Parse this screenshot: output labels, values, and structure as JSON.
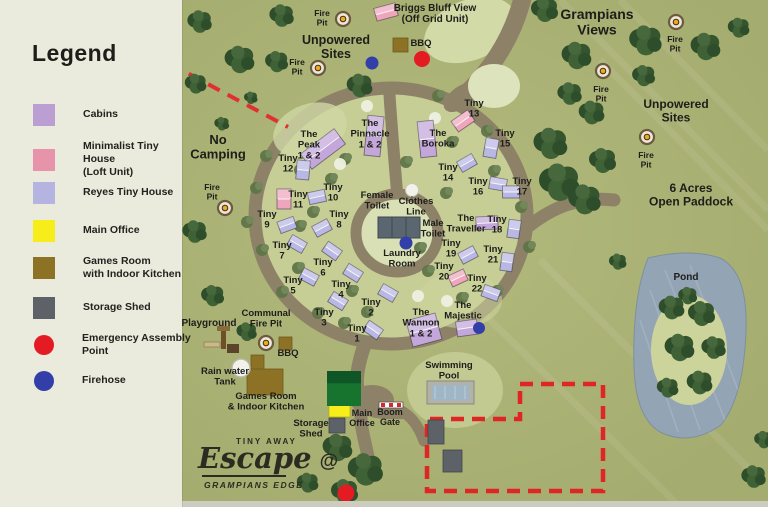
{
  "legend": {
    "title": "Legend",
    "items": [
      {
        "label": "Cabins",
        "color": "#bb9ed2",
        "shape": "square"
      },
      {
        "label": "Minimalist Tiny House\n(Loft Unit)",
        "color": "#e793aa",
        "shape": "square"
      },
      {
        "label": "Reyes Tiny House",
        "color": "#b5b4e0",
        "shape": "square"
      },
      {
        "label": "Main Office",
        "color": "#f7ed1b",
        "shape": "square"
      },
      {
        "label": "Games Room\nwith Indoor Kitchen",
        "color": "#8d7226",
        "shape": "square"
      },
      {
        "label": "Storage Shed",
        "color": "#5d6268",
        "shape": "square"
      },
      {
        "label": "Emergency Assembly\nPoint",
        "color": "#e51b23",
        "shape": "circle"
      },
      {
        "label": "Firehose",
        "color": "#333fa8",
        "shape": "circle"
      }
    ]
  },
  "logo": {
    "brand": "TINY AWAY",
    "script": "Escape",
    "at": "@",
    "sub": "GRAMPIANS EDGE"
  },
  "colors": {
    "cabin": "#c3a6da",
    "loft": "#efa6bd",
    "reyes": "#b9b8e4",
    "office": "#f7ed1b",
    "games": "#8d7226",
    "shed": "#5d6268",
    "emergency": "#e51b23",
    "firehose": "#333fa8",
    "road": "#8d8268",
    "grass": "#a5ac6f",
    "ring_grass": "#c6ce96",
    "light_grass": "#d8dfb4",
    "pond": "#93a4b4",
    "dash_red": "#e02525"
  },
  "map": {
    "labels": [
      {
        "id": "unpowered-sites-top",
        "lines": [
          "Unpowered",
          "Sites"
        ],
        "x": 336,
        "y": 44,
        "size": 12.5
      },
      {
        "id": "grampians-views",
        "lines": [
          "Grampians",
          "Views"
        ],
        "x": 597,
        "y": 19,
        "size": 14
      },
      {
        "id": "unpowered-sites-right",
        "lines": [
          "Unpowered",
          "Sites"
        ],
        "x": 676,
        "y": 108,
        "size": 12
      },
      {
        "id": "six-acres-open-paddock",
        "lines": [
          "6 Acres",
          "Open Paddock"
        ],
        "x": 691,
        "y": 192,
        "size": 12
      },
      {
        "id": "no-camping",
        "lines": [
          "No",
          "Camping"
        ],
        "x": 218,
        "y": 144,
        "size": 13
      },
      {
        "id": "pond",
        "lines": [
          "Pond"
        ],
        "x": 686,
        "y": 280,
        "size": 10
      },
      {
        "id": "female-toilet",
        "lines": [
          "Female",
          "Toilet"
        ],
        "x": 377,
        "y": 198,
        "size": 9.5
      },
      {
        "id": "clothes-line",
        "lines": [
          "Clothes",
          "Line"
        ],
        "x": 416,
        "y": 204,
        "size": 9.5
      },
      {
        "id": "male-toilet",
        "lines": [
          "Male",
          "Toilet"
        ],
        "x": 433,
        "y": 226,
        "size": 9.5
      },
      {
        "id": "laundry-room",
        "lines": [
          "Laundry",
          "Room"
        ],
        "x": 402,
        "y": 256,
        "size": 9.5
      },
      {
        "id": "swimming-pool",
        "lines": [
          "Swimming",
          "Pool"
        ],
        "x": 449,
        "y": 368,
        "size": 9.5
      },
      {
        "id": "main-office",
        "lines": [
          "Main",
          "Office"
        ],
        "x": 362,
        "y": 416,
        "size": 9
      },
      {
        "id": "boom-gate",
        "lines": [
          "Boom",
          "Gate"
        ],
        "x": 390,
        "y": 415,
        "size": 9
      },
      {
        "id": "storage-shed",
        "lines": [
          "Storage",
          "Shed"
        ],
        "x": 311,
        "y": 426,
        "size": 9.5
      },
      {
        "id": "games-room",
        "lines": [
          "Games Room",
          "& Indoor Kitchen"
        ],
        "x": 266,
        "y": 399,
        "size": 9.5
      },
      {
        "id": "rain-water-tank",
        "lines": [
          "Rain water",
          "Tank"
        ],
        "x": 225,
        "y": 374,
        "size": 9.5
      },
      {
        "id": "playground",
        "lines": [
          "Playground"
        ],
        "x": 209,
        "y": 326,
        "size": 10
      },
      {
        "id": "communal-fire-pit",
        "lines": [
          "Communal",
          "Fire Pit"
        ],
        "x": 266,
        "y": 316,
        "size": 9.5
      },
      {
        "id": "bbq-top",
        "lines": [
          "BBQ"
        ],
        "x": 421,
        "y": 46,
        "size": 9.5
      },
      {
        "id": "bbq-bottom",
        "lines": [
          "BBQ"
        ],
        "x": 288,
        "y": 356,
        "size": 9.5
      }
    ],
    "units": [
      {
        "id": "briggs-bluff-view",
        "lines": [
          "Briggs Bluff View",
          "(Off Grid Unit)"
        ],
        "lx": 435,
        "ly": 11,
        "size": 10,
        "bx": 386,
        "by": 12,
        "bw": 22,
        "bh": 13,
        "rot": -15,
        "type": "loft"
      },
      {
        "id": "the-peak",
        "lines": [
          "The",
          "Peak",
          "1 & 2"
        ],
        "lx": 309,
        "ly": 137,
        "bx": 323,
        "by": 149,
        "bw": 42,
        "bh": 19,
        "rot": -37,
        "type": "cabin"
      },
      {
        "id": "the-pinnacle",
        "lines": [
          "The",
          "Pinnacle",
          "1 & 2"
        ],
        "lx": 370,
        "ly": 126,
        "bx": 374,
        "by": 136,
        "bw": 16,
        "bh": 40,
        "rot": 6,
        "type": "cabin"
      },
      {
        "id": "the-boroka",
        "lines": [
          "The",
          "Boroka"
        ],
        "lx": 438,
        "ly": 136,
        "bx": 427,
        "by": 139,
        "bw": 16,
        "bh": 36,
        "rot": -6,
        "type": "cabin"
      },
      {
        "id": "the-traveller",
        "lines": [
          "The",
          "Traveller"
        ],
        "lx": 466,
        "ly": 221,
        "bx": 487,
        "by": 223,
        "bw": 22,
        "bh": 13,
        "rot": -3,
        "type": "cabin"
      },
      {
        "id": "the-wannon",
        "lines": [
          "The",
          "Wannon",
          "1 & 2"
        ],
        "lx": 421,
        "ly": 315,
        "bx": 424,
        "by": 330,
        "bw": 30,
        "bh": 27,
        "rot": -15,
        "type": "cabin"
      },
      {
        "id": "the-majestic",
        "lines": [
          "The",
          "Majestic"
        ],
        "lx": 463,
        "ly": 308,
        "bx": 467,
        "by": 328,
        "bw": 21,
        "bh": 15,
        "rot": -8,
        "type": "cabin"
      },
      {
        "id": "tiny-1",
        "lines": [
          "Tiny",
          "1"
        ],
        "lx": 357,
        "ly": 331,
        "bx": 373,
        "by": 330,
        "rot": 35,
        "type": "reyes"
      },
      {
        "id": "tiny-2",
        "lines": [
          "Tiny",
          "2"
        ],
        "lx": 371,
        "ly": 305,
        "bx": 388,
        "by": 293,
        "rot": 30,
        "type": "reyes"
      },
      {
        "id": "tiny-3",
        "lines": [
          "Tiny",
          "3"
        ],
        "lx": 324,
        "ly": 315,
        "bx": 338,
        "by": 301,
        "rot": 32,
        "type": "reyes"
      },
      {
        "id": "tiny-4",
        "lines": [
          "Tiny",
          "4"
        ],
        "lx": 341,
        "ly": 287,
        "bx": 353,
        "by": 273,
        "rot": 32,
        "type": "reyes"
      },
      {
        "id": "tiny-5",
        "lines": [
          "Tiny",
          "5"
        ],
        "lx": 293,
        "ly": 283,
        "bx": 309,
        "by": 277,
        "rot": 28,
        "type": "reyes"
      },
      {
        "id": "tiny-6",
        "lines": [
          "Tiny",
          "6"
        ],
        "lx": 323,
        "ly": 265,
        "bx": 332,
        "by": 251,
        "rot": 35,
        "type": "reyes"
      },
      {
        "id": "tiny-7",
        "lines": [
          "Tiny",
          "7"
        ],
        "lx": 282,
        "ly": 248,
        "bx": 297,
        "by": 244,
        "rot": 30,
        "type": "reyes"
      },
      {
        "id": "tiny-8",
        "lines": [
          "Tiny",
          "8"
        ],
        "lx": 339,
        "ly": 217,
        "bx": 322,
        "by": 228,
        "rot": -28,
        "type": "reyes"
      },
      {
        "id": "tiny-9",
        "lines": [
          "Tiny",
          "9"
        ],
        "lx": 267,
        "ly": 217,
        "bx": 287,
        "by": 225,
        "rot": -20,
        "type": "reyes"
      },
      {
        "id": "tiny-10",
        "lines": [
          "Tiny",
          "10"
        ],
        "lx": 333,
        "ly": 190,
        "bx": 317,
        "by": 197,
        "rot": -12,
        "type": "reyes"
      },
      {
        "id": "tiny-11",
        "lines": [
          "Tiny",
          "11"
        ],
        "lx": 298,
        "ly": 197,
        "bx": 284,
        "by": 199,
        "rot": 0,
        "type": "loft",
        "bw": 14,
        "bh": 20
      },
      {
        "id": "tiny-12",
        "lines": [
          "Tiny",
          "12"
        ],
        "lx": 288,
        "ly": 161,
        "bx": 303,
        "by": 170,
        "rot": 5,
        "type": "reyes",
        "bw": 13,
        "bh": 19
      },
      {
        "id": "tiny-13",
        "lines": [
          "Tiny",
          "13"
        ],
        "lx": 474,
        "ly": 106,
        "bx": 463,
        "by": 121,
        "rot": -35,
        "type": "loft",
        "bw": 20,
        "bh": 13
      },
      {
        "id": "tiny-14",
        "lines": [
          "Tiny",
          "14"
        ],
        "lx": 448,
        "ly": 170,
        "bx": 467,
        "by": 163,
        "rot": -30,
        "type": "reyes"
      },
      {
        "id": "tiny-15",
        "lines": [
          "Tiny",
          "15"
        ],
        "lx": 505,
        "ly": 136,
        "bx": 491,
        "by": 148,
        "rot": 10,
        "type": "reyes",
        "bw": 13,
        "bh": 19
      },
      {
        "id": "tiny-16",
        "lines": [
          "Tiny",
          "16"
        ],
        "lx": 478,
        "ly": 184,
        "bx": 498,
        "by": 184,
        "rot": 10,
        "type": "reyes"
      },
      {
        "id": "tiny-17",
        "lines": [
          "Tiny",
          "17"
        ],
        "lx": 522,
        "ly": 184,
        "bx": 511,
        "by": 192,
        "rot": 0,
        "type": "reyes"
      },
      {
        "id": "tiny-18",
        "lines": [
          "Tiny",
          "18"
        ],
        "lx": 497,
        "ly": 222,
        "bx": 514,
        "by": 229,
        "rot": 8,
        "type": "reyes",
        "bw": 12,
        "bh": 18
      },
      {
        "id": "tiny-19",
        "lines": [
          "Tiny",
          "19"
        ],
        "lx": 451,
        "ly": 246,
        "bx": 468,
        "by": 255,
        "rot": -28,
        "type": "reyes"
      },
      {
        "id": "tiny-20",
        "lines": [
          "Tiny",
          "20"
        ],
        "lx": 444,
        "ly": 269,
        "bx": 458,
        "by": 278,
        "rot": -25,
        "type": "loft"
      },
      {
        "id": "tiny-21",
        "lines": [
          "Tiny",
          "21"
        ],
        "lx": 493,
        "ly": 252,
        "bx": 507,
        "by": 262,
        "rot": 8,
        "type": "reyes",
        "bw": 12,
        "bh": 18
      },
      {
        "id": "tiny-22",
        "lines": [
          "Tiny",
          "22"
        ],
        "lx": 477,
        "ly": 281,
        "bx": 491,
        "by": 293,
        "rot": 20,
        "type": "reyes"
      }
    ],
    "fire_pits": [
      {
        "x": 343,
        "y": 19,
        "lx": 322,
        "ly": 16,
        "lines": [
          "Fire",
          "Pit"
        ]
      },
      {
        "x": 318,
        "y": 68,
        "lx": 297,
        "ly": 65,
        "lines": [
          "Fire",
          "Pit"
        ]
      },
      {
        "x": 676,
        "y": 22,
        "lx": 675,
        "ly": 42,
        "lines": [
          "Fire",
          "Pit"
        ]
      },
      {
        "x": 603,
        "y": 71,
        "lx": 601,
        "ly": 92,
        "lines": [
          "Fire",
          "Pit"
        ]
      },
      {
        "x": 647,
        "y": 137,
        "lx": 646,
        "ly": 158,
        "lines": [
          "Fire",
          "Pit"
        ]
      },
      {
        "x": 225,
        "y": 208,
        "lx": 212,
        "ly": 190,
        "lines": [
          "Fire",
          "Pit"
        ]
      },
      {
        "x": 266,
        "y": 343,
        "lines": []
      }
    ],
    "markers": [
      {
        "kind": "emergency",
        "x": 422,
        "y": 59,
        "r": 8
      },
      {
        "kind": "emergency",
        "x": 346,
        "y": 493,
        "r": 8.5
      },
      {
        "kind": "firehose",
        "x": 372,
        "y": 63,
        "r": 6.5
      },
      {
        "kind": "firehose",
        "x": 406,
        "y": 243,
        "r": 6.5
      },
      {
        "kind": "firehose",
        "x": 479,
        "y": 328,
        "r": 6
      }
    ],
    "structures": [
      {
        "id": "bbq-grill-top",
        "kind": "bbq",
        "x": 393,
        "y": 38,
        "w": 15,
        "h": 14
      },
      {
        "id": "bbq-grill-bottom",
        "kind": "bbq",
        "x": 279,
        "y": 337,
        "w": 13,
        "h": 13
      },
      {
        "id": "toilet-block",
        "kind": "toilet-block",
        "x": 378,
        "y": 217,
        "w": 42,
        "h": 21
      },
      {
        "id": "main-office-bld",
        "kind": "office",
        "x": 329,
        "y": 405,
        "w": 21,
        "h": 12
      },
      {
        "id": "storage-shed-bld",
        "kind": "shed",
        "x": 329,
        "y": 418,
        "w": 16,
        "h": 15
      },
      {
        "id": "paddock-shed-1",
        "kind": "shed",
        "x": 428,
        "y": 420,
        "w": 16,
        "h": 24
      },
      {
        "id": "paddock-shed-2",
        "kind": "shed",
        "x": 443,
        "y": 450,
        "w": 19,
        "h": 22
      },
      {
        "id": "games-room-annex",
        "kind": "games",
        "x": 251,
        "y": 355,
        "w": 13,
        "h": 17
      },
      {
        "id": "games-room-main",
        "kind": "games",
        "x": 247,
        "y": 369,
        "w": 36,
        "h": 26
      },
      {
        "id": "office-canopy",
        "kind": "canopy",
        "x": 327,
        "y": 371,
        "w": 34,
        "h": 35
      },
      {
        "id": "swimming-pool-bld",
        "kind": "pool",
        "x": 427,
        "y": 381,
        "w": 47,
        "h": 23
      },
      {
        "id": "boom-gate-bld",
        "kind": "gate",
        "x": 379,
        "y": 402,
        "w": 24,
        "h": 6
      },
      {
        "id": "rain-water-tank-bld",
        "kind": "tank",
        "x": 241,
        "y": 368,
        "w": 18,
        "h": 18
      },
      {
        "id": "clothes-line-bld",
        "kind": "blob",
        "x": 412,
        "y": 190,
        "w": 13,
        "h": 13
      },
      {
        "id": "playground-bld",
        "kind": "playground",
        "x": 204,
        "y": 332,
        "w": 34,
        "h": 26
      }
    ]
  }
}
